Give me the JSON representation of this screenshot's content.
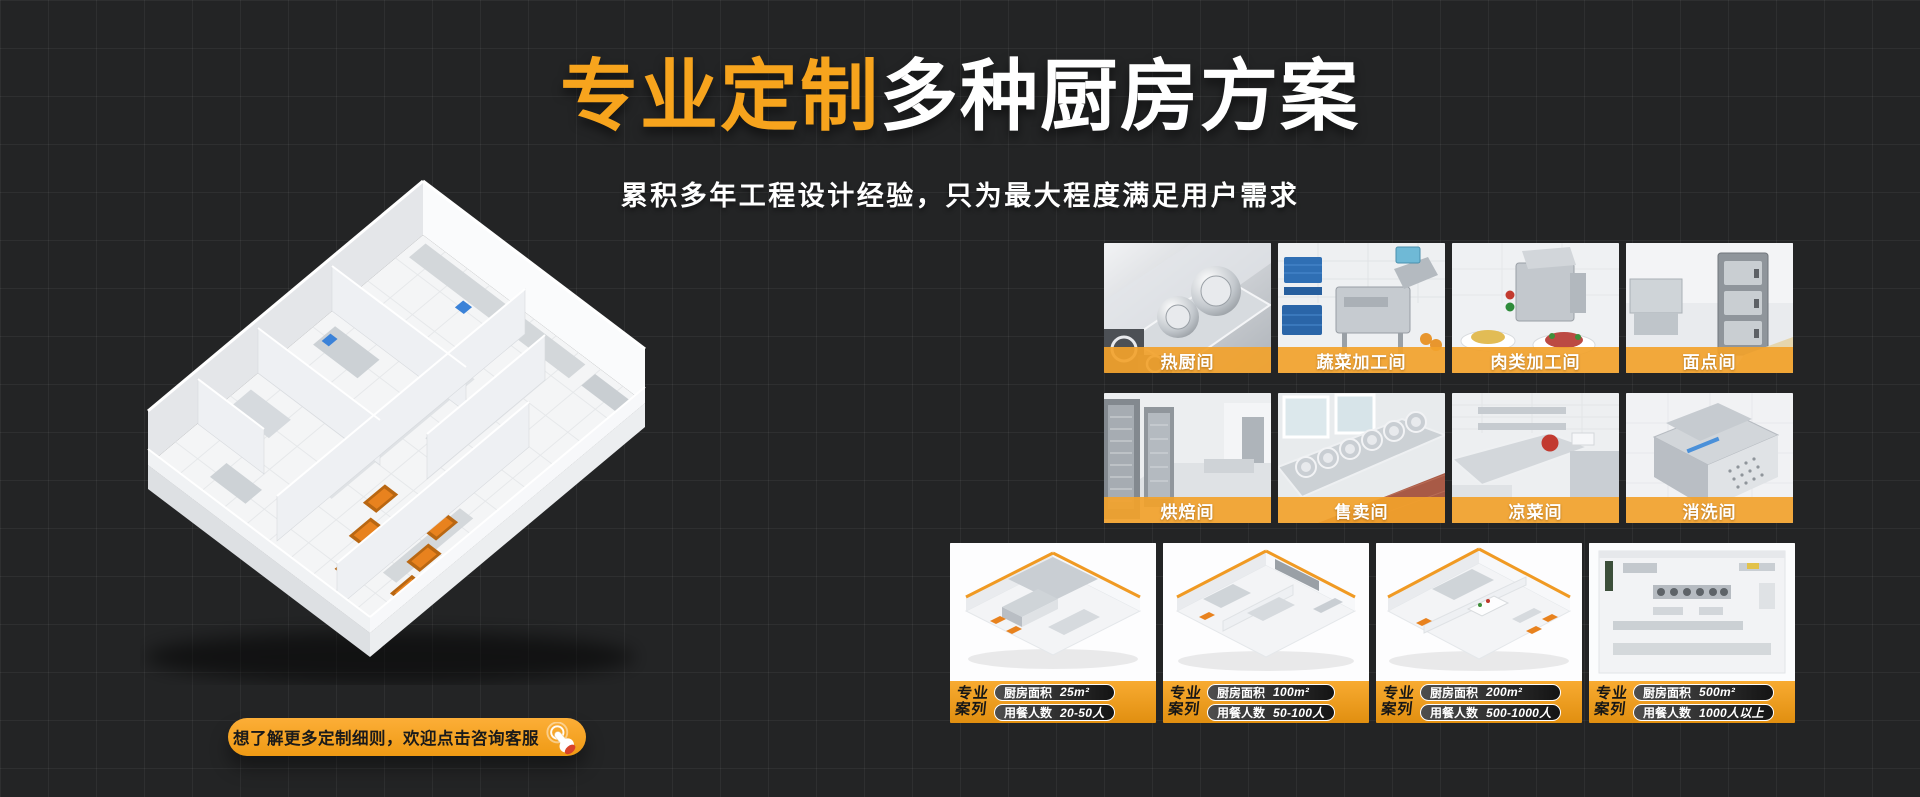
{
  "page": {
    "background": "#232425",
    "grid_line": "rgba(255,255,255,0.05)"
  },
  "colors": {
    "accent_orange": "#F7A41D",
    "label_band_orange": "rgba(242,162,43,0.92)",
    "case_footer_top": "#F8AB31",
    "case_footer_bottom": "#E18F10",
    "cta_top": "#FCAE37",
    "cta_bottom": "#EF9A14",
    "pill_border": "#FFFFFF",
    "text_white": "#FFFFFF",
    "cta_text": "#1A1A1A"
  },
  "header": {
    "title_highlight": "专业定制",
    "title_rest": "多种厨房方案",
    "subtitle": "累积多年工程设计经验，只为最大程度满足用户需求"
  },
  "hero": {
    "illustration": "isometric-kitchen-floorplan"
  },
  "gallery": {
    "items": [
      {
        "label": "热厨间"
      },
      {
        "label": "蔬菜加工间"
      },
      {
        "label": "肉类加工间"
      },
      {
        "label": "面点间"
      },
      {
        "label": "烘焙间"
      },
      {
        "label": "售卖间"
      },
      {
        "label": "凉菜间"
      },
      {
        "label": "消洗间"
      }
    ]
  },
  "cases": {
    "badge_line1": "专业",
    "badge_line2": "案列",
    "area_label": "厨房面积",
    "diners_label": "用餐人数",
    "items": [
      {
        "area": "25m²",
        "diners": "20-50人"
      },
      {
        "area": "100m²",
        "diners": "50-100人"
      },
      {
        "area": "200m²",
        "diners": "500-1000人"
      },
      {
        "area": "500m²",
        "diners": "1000人以上"
      }
    ]
  },
  "cta": {
    "label": "想了解更多定制细则，欢迎点击咨询客服",
    "icon": "click-hand-icon"
  }
}
